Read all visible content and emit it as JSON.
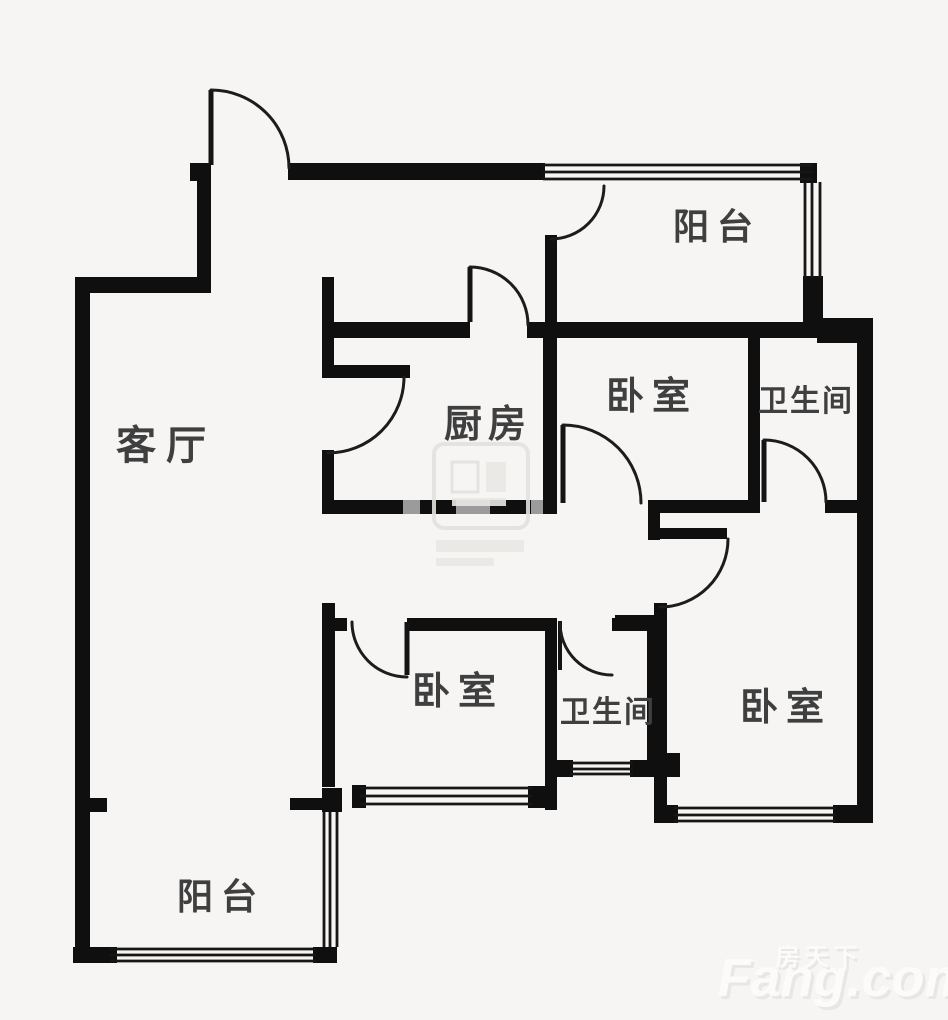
{
  "rooms": [
    {
      "name": "living-room",
      "label": "客厅"
    },
    {
      "name": "kitchen",
      "label": "厨房"
    },
    {
      "name": "bedroom-top",
      "label": "卧室"
    },
    {
      "name": "bathroom-top",
      "label": "卫生间"
    },
    {
      "name": "balcony-top",
      "label": "阳台"
    },
    {
      "name": "bedroom-center",
      "label": "卧室"
    },
    {
      "name": "bathroom-bottom",
      "label": "卫生间"
    },
    {
      "name": "bedroom-right",
      "label": "卧室"
    },
    {
      "name": "balcony-bottom",
      "label": "阳台"
    }
  ],
  "watermark": {
    "brand_cn": "房天下",
    "brand_en": "Fang.com"
  },
  "colors": {
    "background": "#f6f5f3",
    "wall": "#0f0f0f",
    "label": "#3f3f3f",
    "watermark": "#fcfbfa"
  }
}
